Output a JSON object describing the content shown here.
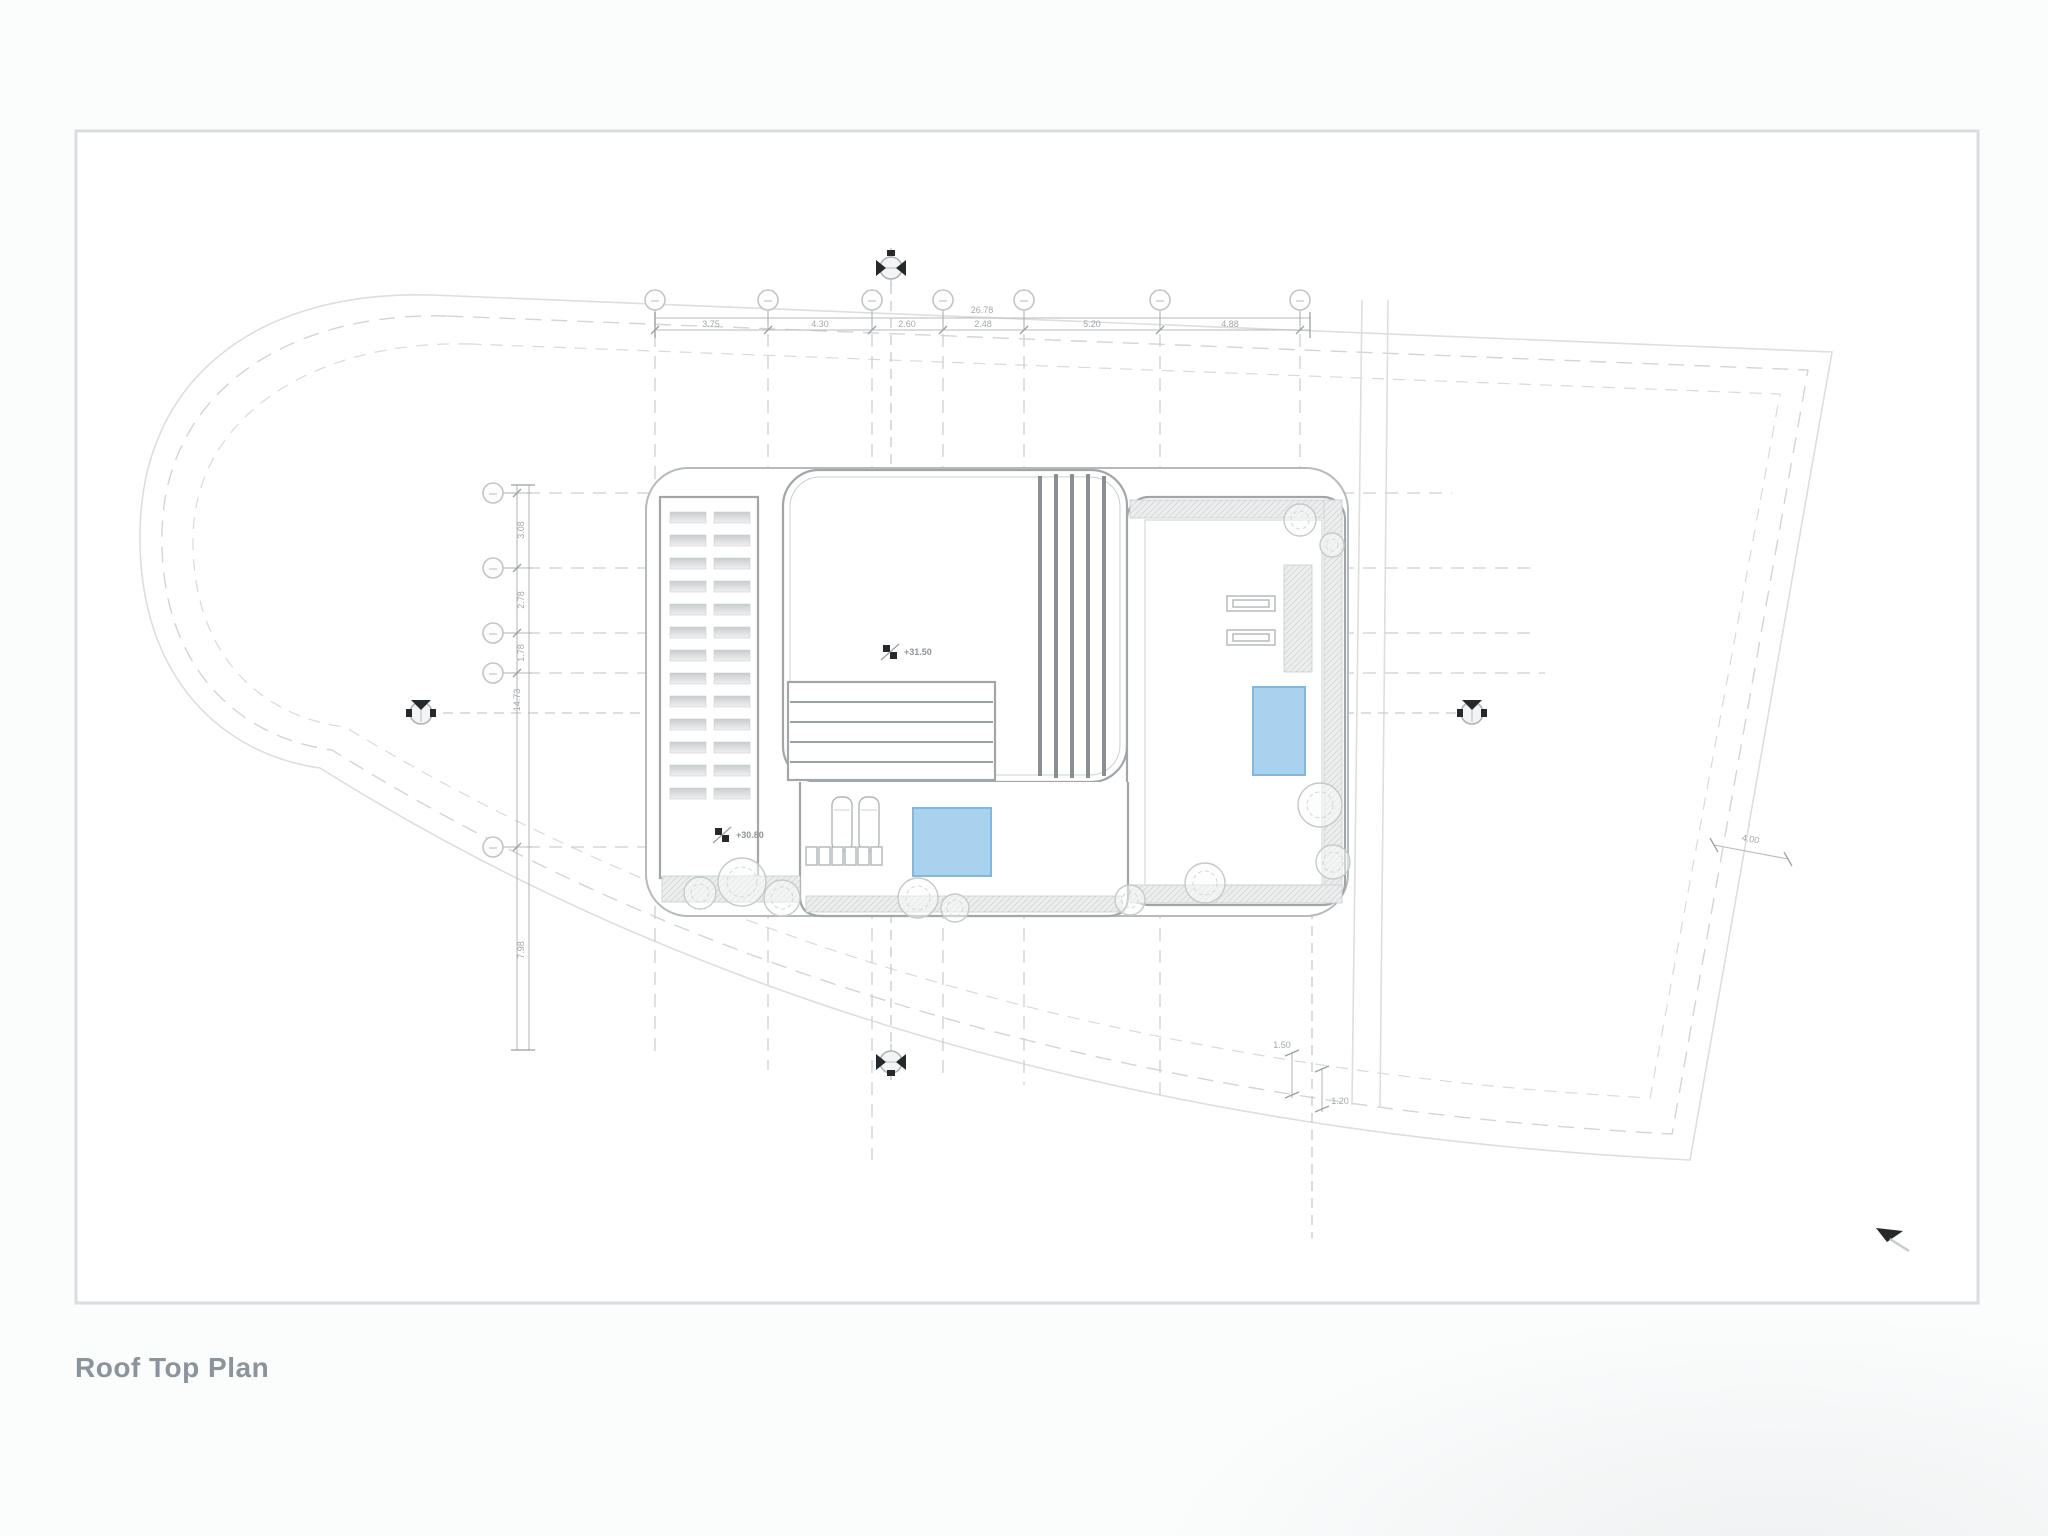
{
  "title": "Roof Top Plan",
  "dims": {
    "top_overall": "26.78",
    "top_segments": [
      "3.75",
      "4.30",
      "2.60",
      "2.48",
      "5.20",
      "4.88"
    ],
    "left_segments": [
      "3.08",
      "2.78",
      "1.78",
      "14.73",
      "7.98"
    ],
    "right_slope": "4.00",
    "notch_a": "1.50",
    "notch_b": "1.20"
  },
  "levels": {
    "roof_level": "+31.50",
    "terrace_level": "+30.80"
  },
  "colors": {
    "pool_fill": "#a9d2ee",
    "pool_edge": "#84b7d9",
    "sheet_border": "#dadde0",
    "drawing_lines": "#a2a6a9",
    "title_text": "#8b949b"
  }
}
